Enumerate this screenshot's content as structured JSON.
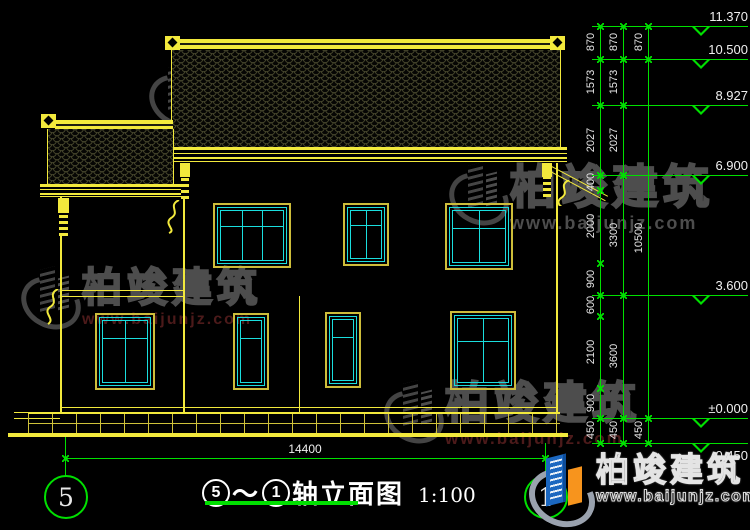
{
  "colors": {
    "yellow": "#f2e93c",
    "green": "#00e000",
    "cyan": "#1adede",
    "frame": "#cdbd3a"
  },
  "watermark": {
    "brand": "柏竣建筑",
    "url": "www.baijunjz.com"
  },
  "logo": {
    "brand": "柏竣建筑",
    "url": "www.baijunjz.com"
  },
  "title_bar": {
    "axis_from": "5",
    "tilde": "～",
    "axis_to": "1",
    "name": "轴立面图",
    "scale": "1:100"
  },
  "bottom_dim": {
    "label": "14400"
  },
  "axis_bubbles": [
    {
      "label": "5"
    },
    {
      "label": "1"
    }
  ],
  "levels": [
    {
      "label": "11.370",
      "y": 26
    },
    {
      "label": "10.500",
      "y": 59
    },
    {
      "label": "8.927",
      "y": 105
    },
    {
      "label": "6.900",
      "y": 175
    },
    {
      "label": "3.600",
      "y": 295
    },
    {
      "label": "±0.000",
      "y": 418
    },
    {
      "label": "-0.450",
      "y": 443,
      "below": true
    }
  ],
  "chains": [
    {
      "x": 600,
      "segments": [
        {
          "label": "870",
          "mid": 42
        },
        {
          "label": "1573",
          "mid": 82
        },
        {
          "label": "2027",
          "mid": 140
        },
        {
          "label": "400",
          "mid": 182
        },
        {
          "label": "2000",
          "mid": 226
        },
        {
          "label": "900",
          "mid": 279
        },
        {
          "label": "600",
          "mid": 305
        },
        {
          "label": "2100",
          "mid": 352
        },
        {
          "label": "900",
          "mid": 403
        },
        {
          "label": "450",
          "mid": 430
        }
      ],
      "boundaries": [
        26,
        59,
        105,
        175,
        190,
        263,
        295,
        316,
        388,
        418,
        443
      ]
    },
    {
      "x": 623,
      "segments": [
        {
          "label": "870",
          "mid": 42
        },
        {
          "label": "1573",
          "mid": 82
        },
        {
          "label": "2027",
          "mid": 140
        },
        {
          "label": "3300",
          "mid": 235
        },
        {
          "label": "3600",
          "mid": 356
        },
        {
          "label": "450",
          "mid": 430
        }
      ],
      "boundaries": [
        26,
        59,
        105,
        175,
        295,
        418,
        443
      ]
    },
    {
      "x": 648,
      "segments": [
        {
          "label": "870",
          "mid": 42
        },
        {
          "label": "10500",
          "mid": 238
        },
        {
          "label": "450",
          "mid": 430
        }
      ],
      "boundaries": [
        26,
        59,
        418,
        443
      ]
    }
  ]
}
